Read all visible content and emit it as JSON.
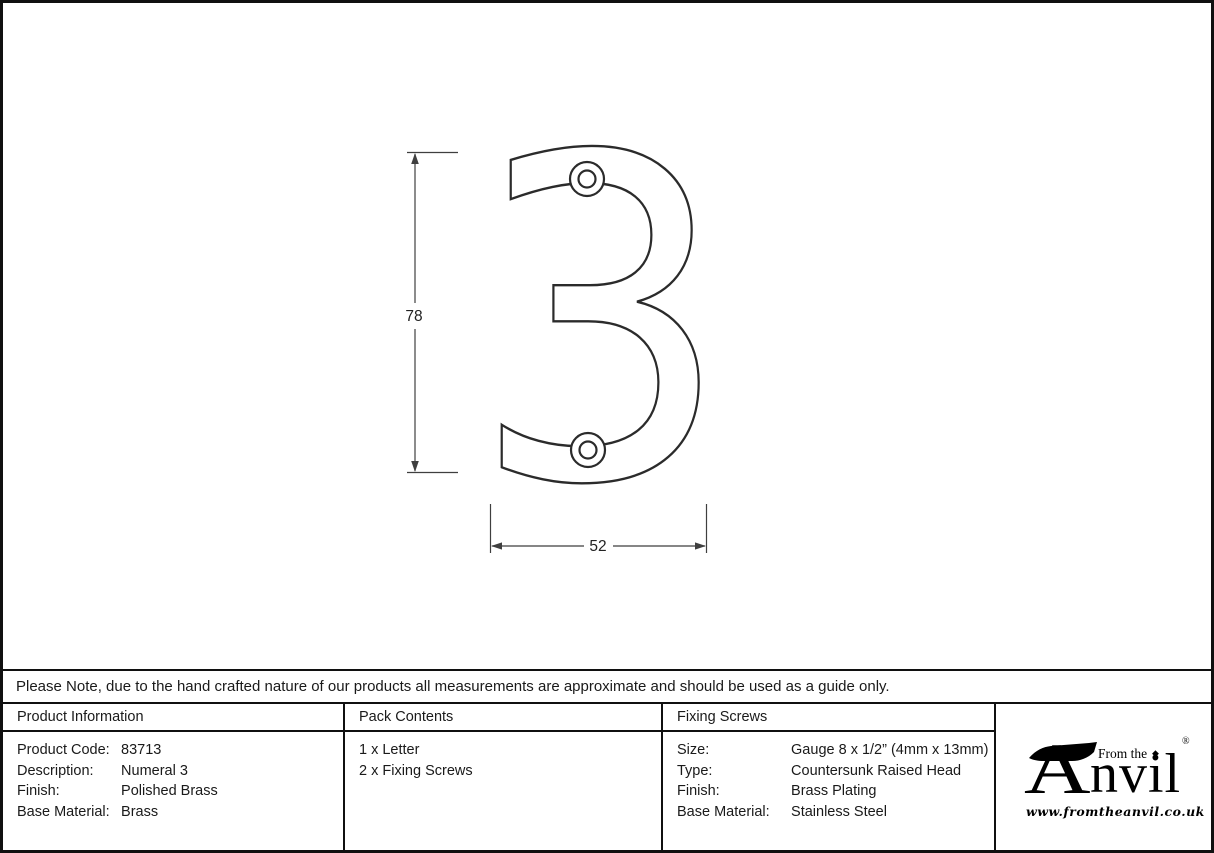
{
  "drawing": {
    "numeral": "3",
    "height_label": "78",
    "width_label": "52"
  },
  "note": "Please Note, due to the hand crafted nature of our products all measurements are approximate and should be used as a guide only.",
  "table": {
    "product_info": {
      "header": "Product Information",
      "rows": [
        {
          "label": "Product Code:",
          "value": "83713"
        },
        {
          "label": "Description:",
          "value": "Numeral 3"
        },
        {
          "label": "Finish:",
          "value": "Polished Brass"
        },
        {
          "label": "Base Material:",
          "value": "Brass"
        }
      ]
    },
    "pack_contents": {
      "header": "Pack Contents",
      "items": [
        "1 x Letter",
        "2 x Fixing Screws"
      ]
    },
    "fixing_screws": {
      "header": "Fixing Screws",
      "rows": [
        {
          "label": "Size:",
          "value": "Gauge 8 x 1/2” (4mm x 13mm)"
        },
        {
          "label": "Type:",
          "value": "Countersunk Raised Head"
        },
        {
          "label": "Finish:",
          "value": "Brass Plating"
        },
        {
          "label": "Base Material:",
          "value": "Stainless Steel"
        }
      ]
    }
  },
  "logo": {
    "tagline": "From the",
    "brand_initial": "A",
    "brand_rest": "nvil",
    "diamond": "◆",
    "registered": "®",
    "url": "www.fromtheanvil.co.uk"
  },
  "colors": {
    "border": "#101010",
    "drawing_line": "#2b2b2b",
    "dimension_line": "#3f3f3f"
  }
}
